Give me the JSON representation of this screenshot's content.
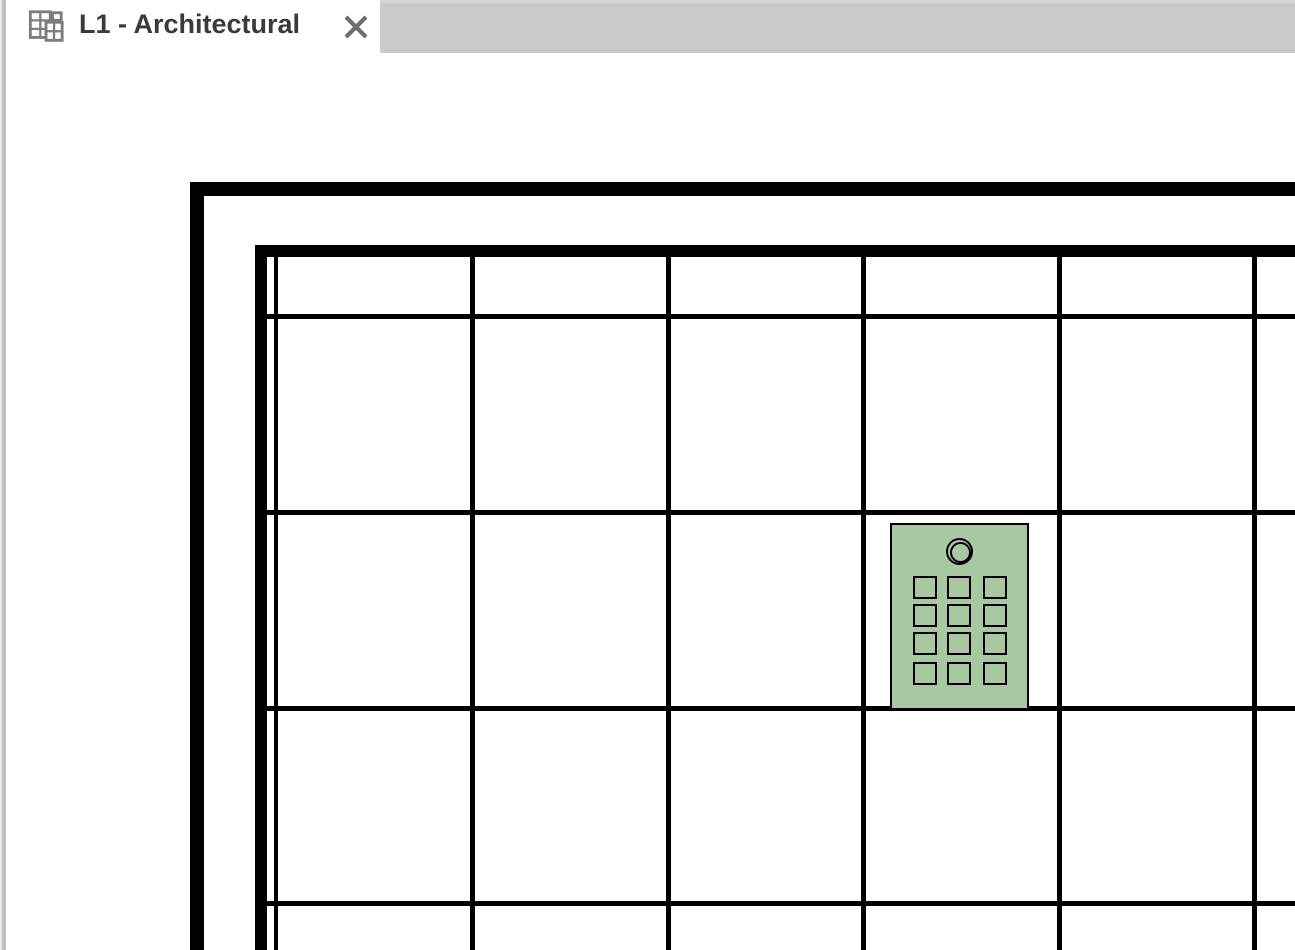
{
  "tab_bar": {
    "background": "#cacaca",
    "active_tab": {
      "title": "L1 - Architectural",
      "icon": "floor-plan-view-icon",
      "close_icon": "close-icon",
      "background": "#ffffff",
      "title_color": "#3a3a3a"
    }
  },
  "side_strip": {
    "role": "panel-splitter",
    "color": "#bfbfbf"
  },
  "drawing": {
    "background": "#ffffff",
    "line_color": "#000000",
    "walls": [
      {
        "name": "outer-wall-top",
        "x": 190,
        "y": 182,
        "w": 1105,
        "h": 14
      },
      {
        "name": "outer-wall-left",
        "x": 190,
        "y": 182,
        "w": 14,
        "h": 768
      },
      {
        "name": "inner-wall-top",
        "x": 255,
        "y": 245,
        "w": 1040,
        "h": 12
      },
      {
        "name": "inner-wall-left",
        "x": 255,
        "y": 245,
        "w": 12,
        "h": 705
      }
    ],
    "ceiling_grid": {
      "vertical_extent": {
        "y1": 257,
        "y2": 950
      },
      "horizontal_extent": {
        "x1": 267,
        "x2": 1295
      },
      "vertical_lines": [
        {
          "x": 274,
          "w": 4
        },
        {
          "x": 470,
          "w": 5
        },
        {
          "x": 666,
          "w": 5
        },
        {
          "x": 861,
          "w": 5
        },
        {
          "x": 1057,
          "w": 5
        },
        {
          "x": 1252,
          "w": 5
        }
      ],
      "horizontal_lines": [
        {
          "y": 314,
          "h": 5
        },
        {
          "y": 510,
          "h": 5
        },
        {
          "y": 706,
          "h": 5
        },
        {
          "y": 901,
          "h": 5
        }
      ]
    },
    "equipment_panel": {
      "name": "panel-equipment-symbol",
      "x": 890,
      "y": 523,
      "w": 139,
      "h": 187,
      "fill": "#a9c7a3",
      "stroke": "#000000",
      "circle": {
        "cx": 959,
        "cy": 551,
        "outer_d": 27,
        "inner_d": 21
      },
      "cells": {
        "cols_x": [
          913,
          947,
          983
        ],
        "rows_y": [
          576,
          604,
          632,
          662
        ],
        "cell_w": 24,
        "cell_h": 23
      }
    }
  }
}
